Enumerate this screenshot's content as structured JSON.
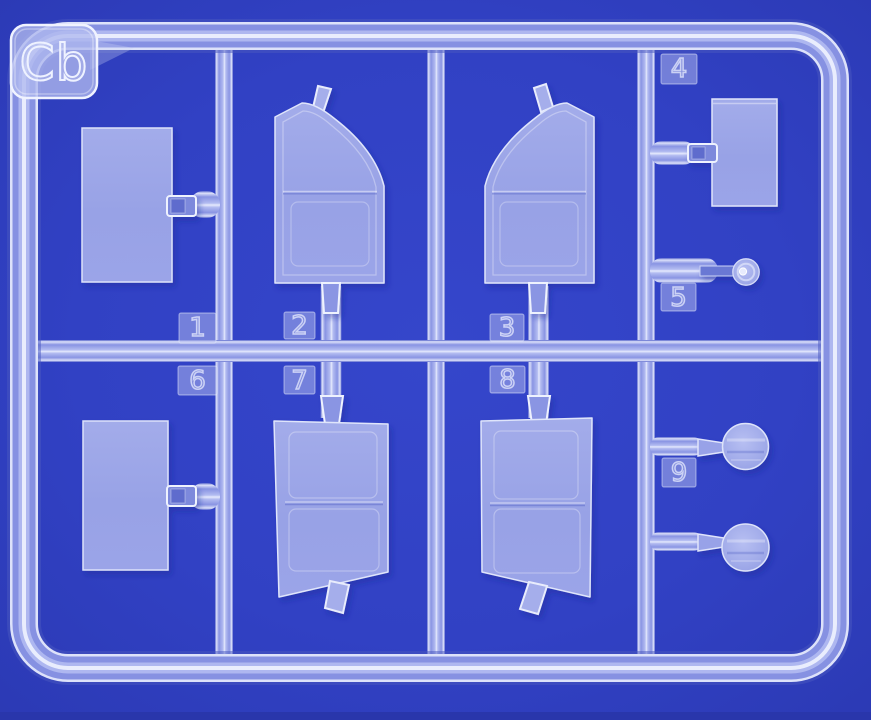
{
  "scene": {
    "sprue_label": "Cb",
    "part_tags": [
      "1",
      "2",
      "3",
      "4",
      "5",
      "6",
      "7",
      "8",
      "9"
    ],
    "parts": [
      {
        "number": "1",
        "kind": "rectangular-panel"
      },
      {
        "number": "2",
        "kind": "curved-top-door-right"
      },
      {
        "number": "3",
        "kind": "curved-top-door-left"
      },
      {
        "number": "4",
        "kind": "small-rectangular-panel"
      },
      {
        "number": "5",
        "kind": "small-disc-with-hub"
      },
      {
        "number": "6",
        "kind": "rectangular-panel"
      },
      {
        "number": "7",
        "kind": "door-inner-panel"
      },
      {
        "number": "8",
        "kind": "door-inner-panel"
      },
      {
        "number": "9",
        "kind": "round-disc-pair"
      }
    ],
    "colors": {
      "background": "#3141C4",
      "plastic": "#98A2E6",
      "plastic_edge": "#E6EAFC",
      "tube_body": "#8591E2",
      "tube_highlight": "#E9EDFD",
      "bottom_strip": "#2936AB"
    }
  }
}
